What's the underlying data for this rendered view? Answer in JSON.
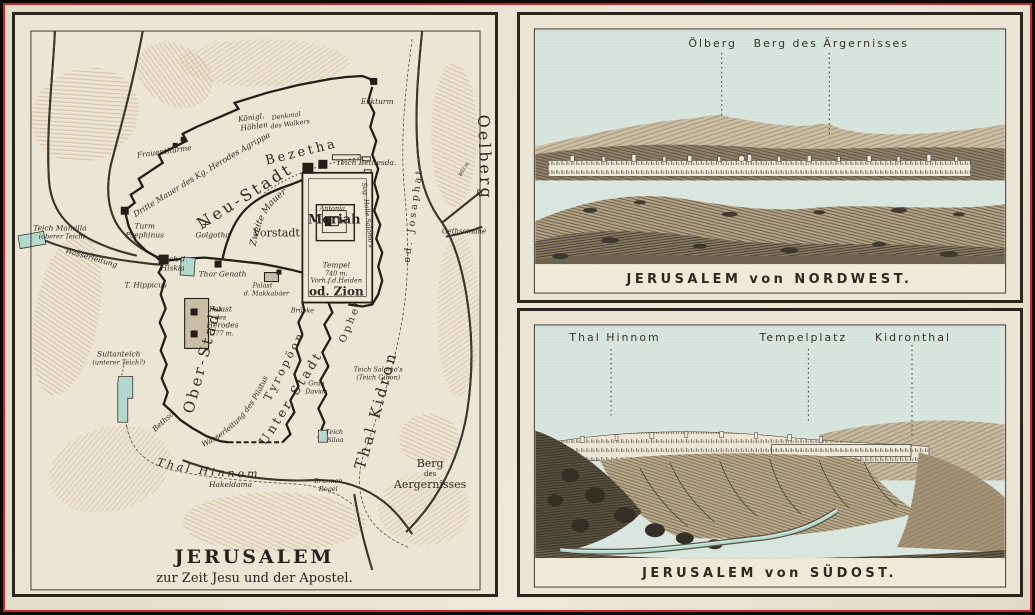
{
  "palette": {
    "paper": "#e9e1d0",
    "ink": "#2e2a22",
    "terrain": "#c2a37f",
    "water": "#b3d8ce",
    "sky": "#d9e5df",
    "frame_red": "#c3282c",
    "edge_black": "#0d0b08"
  },
  "map": {
    "title": "JERUSALEM",
    "subtitle": "zur Zeit Jesu und der Apostel.",
    "labels": {
      "teich_mamilla_1": "Teich Mamilla",
      "teich_mamilla_2": "(oberer Teich)",
      "wasserleitung_west": "Wasserleitung",
      "frauenthuerme": "Frauenthürme",
      "dritte_mauer": "Dritte Mauer des Kg. Herodes Agrippa",
      "koenigl_1": "Königl.",
      "koenigl_2": "Höhlen",
      "denkmal_1": "Denkmal",
      "denkmal_2": "des Walkers",
      "eckturm": "Eckturm",
      "bezetha": "Bezetha",
      "neu_stadt": "Neu-Stadt",
      "teich_bethesda": "Teich Bethesda.",
      "turm_1": "Turm",
      "turm_2": "Psephinus",
      "golgotha": "Golgotha",
      "golgotha_cross": "+",
      "vorstadt": "Vorstadt",
      "zweite_mauer": "Zweite Mauer",
      "antonia": "Antonia",
      "moriah": "Moriah",
      "halle_salomos": "Sog. Halle Salomo's",
      "tempel": "Tempel",
      "tempel_hoehe": "740 m.",
      "vorhof": "Vorh.f.d.Heiden",
      "od_zion": "od. Zion",
      "bruecke": "Brücke",
      "teich_hiskia_1": "Teich d.",
      "teich_hiskia_2": "Hiskia",
      "thor_genath": "Thor Genath",
      "t_hippicus": "T. Hippicus",
      "palast_makk_1": "Palast",
      "palast_makk_2": "d. Makkabäer",
      "palast_herodes_1": "Palast",
      "palast_herodes_2": "des",
      "palast_herodes_3": "Herodes",
      "palast_herodes_4": "777 m.",
      "sultanteich_1": "Sultanteich",
      "sultanteich_2": "(unterer Teich?)",
      "ober_stadt": "Ober-Stadt",
      "bethso": "Bethso",
      "wasserleitung_pilatus": "Wasserleitung des Pilatus",
      "tyropoeon": "Tyropöon",
      "unter_stadt": "Unter-Stadt",
      "ophel": "Ophel",
      "grab_davids_1": "Grab",
      "grab_davids_2": "Davids",
      "teich_salomos_1": "Teich Salomo's",
      "teich_salomos_2": "(Teich Gihon)",
      "teich_siloa_1": "Teich",
      "teich_siloa_2": "Siloa",
      "thal_kidron": "Thal Kidron",
      "josaphat": "od. Josaphat",
      "gethsemane": "Gethsemane",
      "oelberg": "Oelberg",
      "hoehe_803": "803 m",
      "thal_hinnom": "Thal Hinnom",
      "hakeldama": "Hakeldama",
      "brunnen_1": "Brunnen",
      "brunnen_2": "Rogel",
      "berg_1": "Berg",
      "berg_2": "des",
      "berg_3": "Aergernisses"
    }
  },
  "panorama_nw": {
    "caption": "JERUSALEM von NORDWEST.",
    "labels": [
      "Ölberg",
      "Berg des Ärgernisses"
    ]
  },
  "panorama_se": {
    "caption": "JERUSALEM von SÜDOST.",
    "labels": [
      "Thal Hinnom",
      "Tempelplatz",
      "Kidronthal"
    ]
  }
}
